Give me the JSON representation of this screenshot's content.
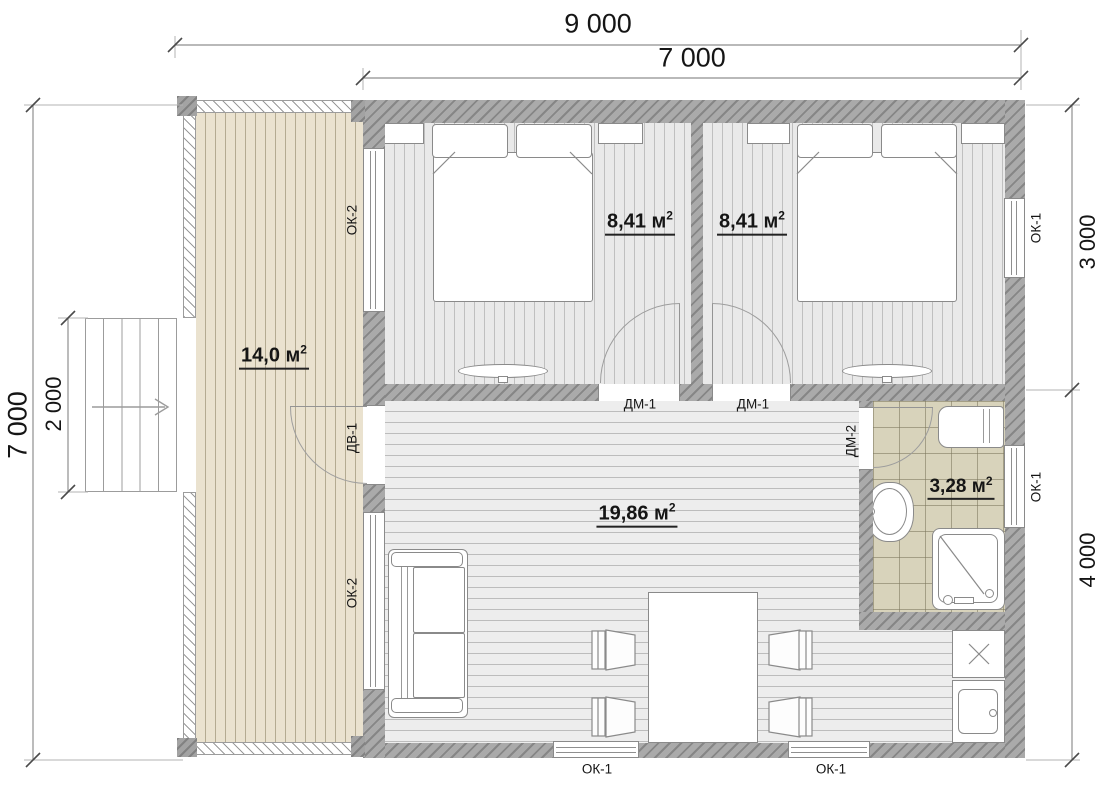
{
  "dimensions": {
    "top_total": "9 000",
    "top_main": "7 000",
    "left_total": "7 000",
    "left_stairs": "2 000",
    "right_upper": "3 000",
    "right_lower": "4 000"
  },
  "rooms": {
    "terrace": {
      "area": "14,0 м",
      "area_sup": "2"
    },
    "bedroom_left": {
      "area": "8,41 м",
      "area_sup": "2"
    },
    "bedroom_right": {
      "area": "8,41 м",
      "area_sup": "2"
    },
    "living": {
      "area": "19,86 м",
      "area_sup": "2"
    },
    "bathroom": {
      "area": "3,28 м",
      "area_sup": "2"
    }
  },
  "openings": {
    "window_type_1": "ОК-1",
    "window_type_2": "ОК-2",
    "entrance_door": "ДВ-1",
    "interior_door": "ДМ-1",
    "bathroom_door": "ДМ-2"
  },
  "colors": {
    "wall_gray": "#a5a5a5",
    "terrace_floor": "#eae2cf",
    "bedroom_floor": "#e9e9e9",
    "living_floor": "#ededed",
    "bathroom_tile": "#d8d3bb",
    "outline": "#8a8a8a",
    "text": "#151515"
  }
}
